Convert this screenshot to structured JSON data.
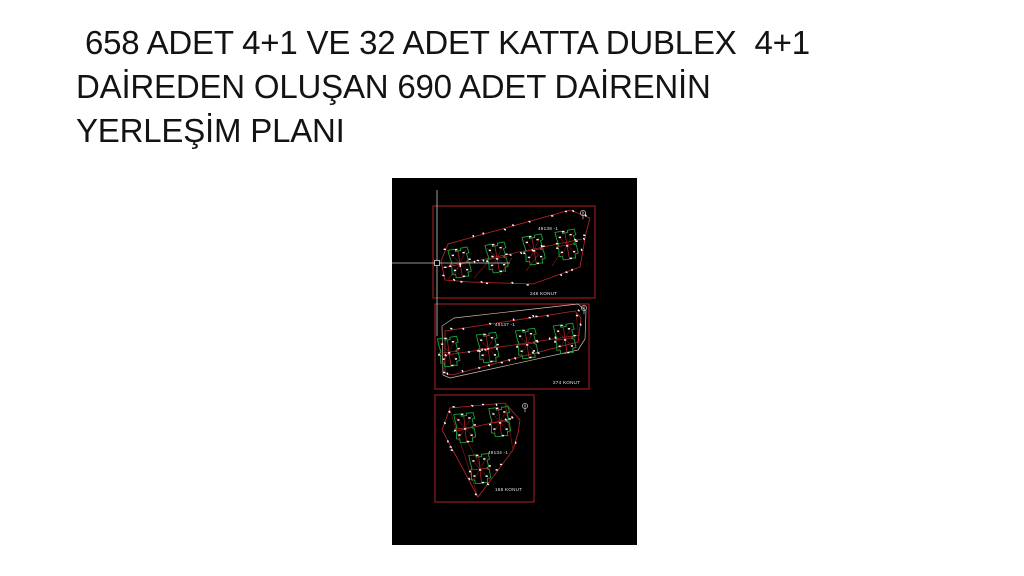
{
  "title": {
    "lines": [
      " 658 ADET 4+1 VE 32 ADET KATTA DUBLEX  4+1",
      "DAİREDEN OLUŞAN 690 ADET DAİRENİN",
      "YERLEŞİM PLANI"
    ]
  },
  "cad": {
    "canvas": {
      "left": 392,
      "top": 178,
      "width": 245,
      "height": 367,
      "background": "#000000"
    },
    "colors": {
      "border": "#a11d1d",
      "parcel": "#c02525",
      "dark_red": "#7d1414",
      "building": "#1aa23c",
      "outer_line": "#cdb9ac",
      "tick": "#ffffff",
      "label": "#e9e9e9",
      "crosshair": "#c3c7c9"
    },
    "crosshair": {
      "x": 45,
      "y": 85,
      "h_from": 0,
      "h_to": 118,
      "v_from": 12,
      "v_to": 158,
      "pickbox": 5
    },
    "blocks": [
      {
        "parcel_id": "49138 -1",
        "units_label": "248  KONUT",
        "rect": [
          41,
          28,
          162,
          92
        ],
        "parcel": [
          [
            49,
            83
          ],
          [
            56,
            66
          ],
          [
            178,
            32
          ],
          [
            198,
            40
          ],
          [
            194,
            55
          ],
          [
            188,
            89
          ],
          [
            141,
            106
          ],
          [
            78,
            104
          ],
          [
            53,
            102
          ]
        ],
        "outer": [],
        "buildings": [
          [
            68,
            85,
            -10
          ],
          [
            105,
            80,
            -10
          ],
          [
            142,
            72,
            -10
          ],
          [
            175,
            67,
            -10
          ]
        ],
        "row_line": [
          [
            50,
            90
          ],
          [
            190,
            61
          ]
        ],
        "extra_lines": [
          [
            [
              56,
              101
            ],
            [
              68,
              88
            ]
          ],
          [
            [
              82,
              100
            ],
            [
              96,
              84
            ]
          ],
          [
            [
              108,
              97
            ],
            [
              120,
              80
            ]
          ],
          [
            [
              134,
              93
            ],
            [
              146,
              77
            ]
          ],
          [
            [
              160,
              88
            ],
            [
              170,
              73
            ]
          ]
        ],
        "id_pos": [
          146,
          52
        ],
        "units_pos": [
          138,
          117
        ],
        "north": [
          191,
          35
        ]
      },
      {
        "parcel_id": "49137 -1",
        "units_label": "274 KONUT",
        "rect": [
          43,
          126,
          154,
          85
        ],
        "parcel": [
          [
            53,
            195
          ],
          [
            53,
            153
          ],
          [
            183,
            133
          ],
          [
            189,
            140
          ],
          [
            186,
            164
          ],
          [
            120,
            181
          ],
          [
            60,
            197
          ]
        ],
        "outer": [
          [
            51,
            197
          ],
          [
            50,
            148
          ],
          [
            62,
            140
          ],
          [
            186,
            126
          ],
          [
            194,
            133
          ],
          [
            193,
            161
          ],
          [
            186,
            172
          ],
          [
            58,
            200
          ]
        ],
        "buildings": [
          [
            57,
            174,
            -8
          ],
          [
            96,
            170,
            -8
          ],
          [
            135,
            166,
            -8
          ],
          [
            173,
            161,
            -8
          ]
        ],
        "row_line": [
          [
            48,
            178
          ],
          [
            188,
            157
          ]
        ],
        "extra_lines": [
          [
            [
              184,
              134
            ],
            [
              187,
              163
            ]
          ]
        ],
        "id_pos": [
          103,
          148
        ],
        "units_pos": [
          161,
          206
        ],
        "north": [
          192,
          130
        ]
      },
      {
        "parcel_id": "49134 -1",
        "units_label": "168 KONUT",
        "rect": [
          43,
          217,
          99,
          107
        ],
        "parcel": [
          [
            58,
            230
          ],
          [
            113,
            225
          ],
          [
            128,
            242
          ],
          [
            126,
            255
          ],
          [
            121,
            272
          ],
          [
            86,
            319
          ],
          [
            50,
            252
          ]
        ],
        "outer": [],
        "buildings": [
          [
            73,
            250,
            -6
          ],
          [
            108,
            244,
            -6
          ],
          [
            88,
            291,
            -6
          ]
        ],
        "row_line": [
          [
            60,
            254
          ],
          [
            122,
            240
          ]
        ],
        "extra_lines": [
          [
            [
              113,
              225
            ],
            [
              121,
              272
            ]
          ],
          [
            [
              58,
              232
            ],
            [
              85,
              316
            ]
          ],
          [
            [
              75,
              262
            ],
            [
              88,
              288
            ]
          ]
        ],
        "id_pos": [
          96,
          276
        ],
        "units_pos": [
          103,
          313
        ],
        "north": [
          133,
          228
        ]
      }
    ]
  }
}
